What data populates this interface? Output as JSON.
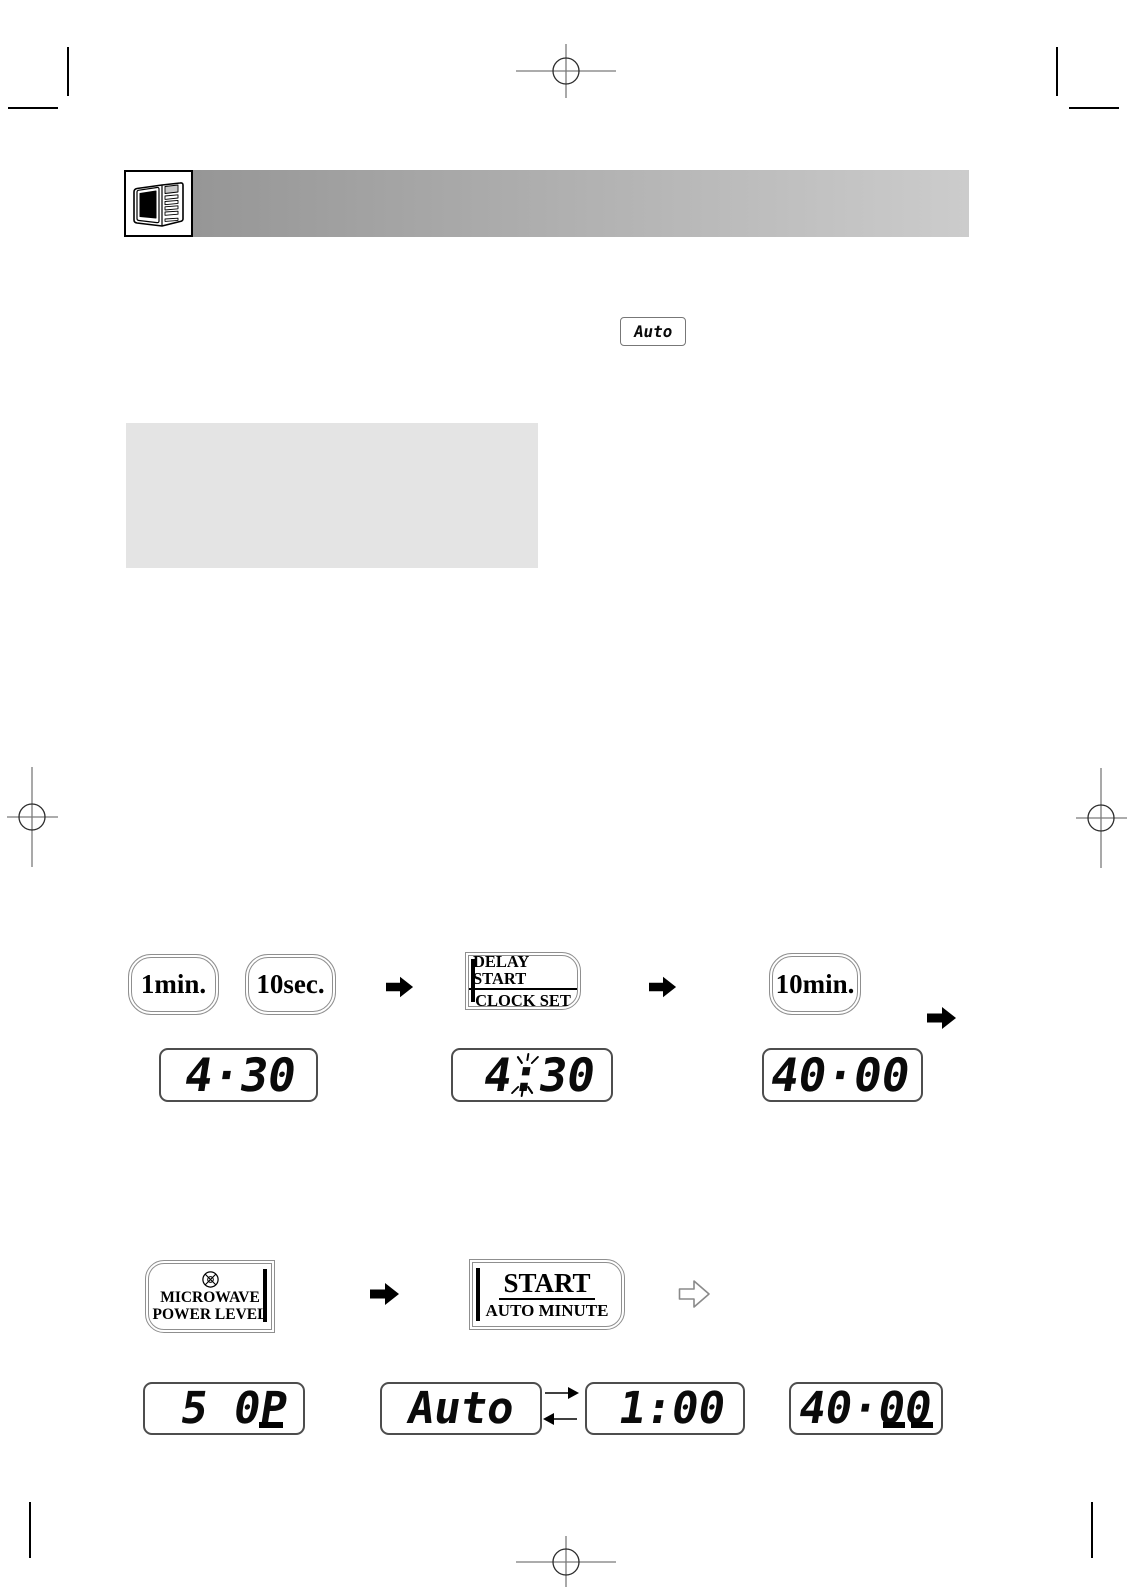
{
  "colors": {
    "header_gradient_start": "#969696",
    "header_gradient_end": "#cccccc",
    "note_box": "#e4e4e4"
  },
  "header": {
    "icon": "microwave"
  },
  "auto_indicator": {
    "value": "Auto"
  },
  "step1": {
    "buttons": {
      "one_min": "1min.",
      "ten_sec": "10sec.",
      "delay_line1": "DELAY START",
      "delay_line2": "CLOCK SET",
      "ten_min": "10min."
    },
    "displays": {
      "cook_time": "4·30",
      "clock_left": "4",
      "clock_colon": ":",
      "clock_right": "30",
      "delay_time": "40·00"
    }
  },
  "step2": {
    "buttons": {
      "power_line1": "MICROWAVE",
      "power_line2": "POWER LEVEL",
      "start_line1": "START",
      "start_line2": "AUTO MINUTE"
    },
    "displays": {
      "power_level": "5 0P",
      "auto": "Auto",
      "time": "1:00",
      "delay_time": "40·00"
    }
  }
}
